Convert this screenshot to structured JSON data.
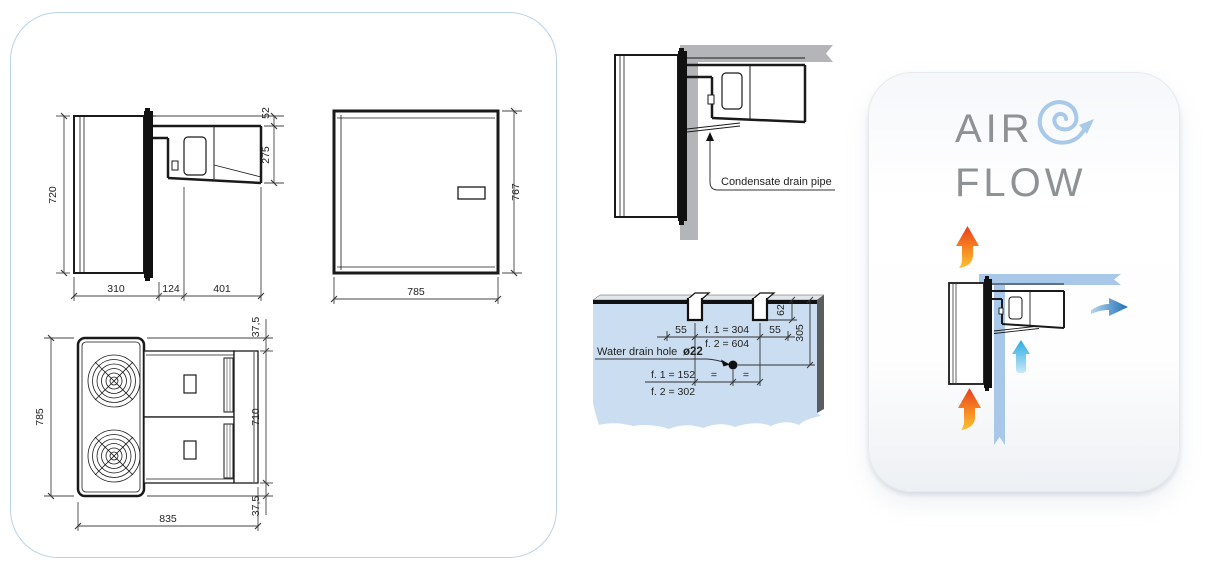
{
  "drawings": {
    "side_view": {
      "height": "720",
      "roof_offset": "52",
      "unit_height": "275",
      "depth_inside": "310",
      "depth_wall": "124",
      "depth_outside": "401"
    },
    "front_view": {
      "width": "785",
      "height": "767"
    },
    "top_view": {
      "width": "785",
      "top_flange": "37,5",
      "body": "710",
      "bottom_flange": "37,5",
      "length": "835"
    }
  },
  "installation": {
    "condensate_label": "Condensate drain pipe",
    "water_drain": {
      "label": "Water drain hole",
      "diameter": "ø22",
      "left_offset": "55",
      "pitch_f1": "f. 1 = 304",
      "pitch_f2": "f. 2 = 604",
      "right_offset": "55",
      "slot_width": "62",
      "depth": "305",
      "center_f1": "f. 1 = 152",
      "center_f2": "f. 2 = 302",
      "equal_left": "=",
      "equal_right": "="
    }
  },
  "airflow": {
    "word1": "AIR",
    "word2": "FLOW"
  },
  "colors": {
    "panel_border": "#b9d2e8",
    "wall_gray": "#b3b5b8",
    "wall_panel_blue": "#cbdef1",
    "airflow_band": "#a9c7e9",
    "hot_arrow_top": "#e73c1e",
    "hot_arrow_bottom": "#fdc330",
    "cold_arrow_dark": "#1b6fb5",
    "cold_arrow_light": "#29abe2",
    "title_text": "#8e9294",
    "swirl_blue": "#a8c9ea"
  }
}
